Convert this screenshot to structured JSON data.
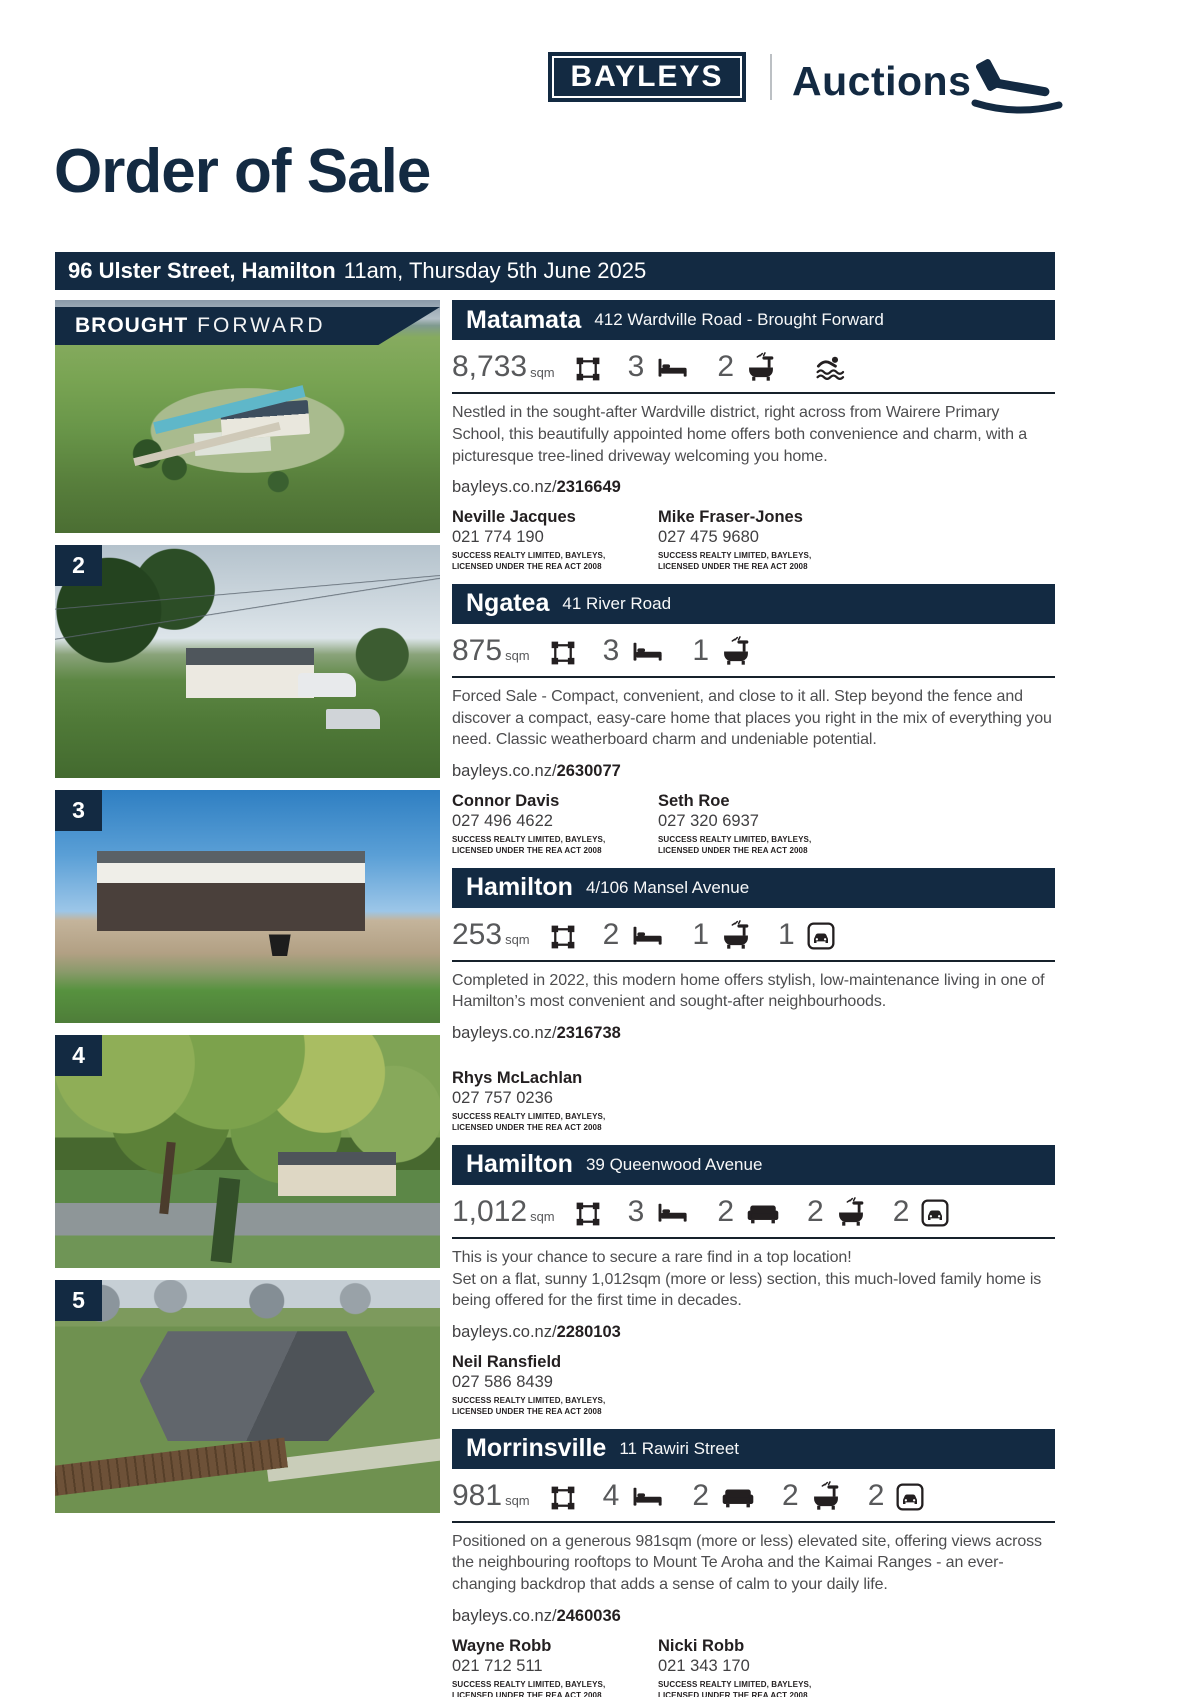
{
  "colors": {
    "navy": "#132a42",
    "body_text": "#4d4d4f",
    "stat_gray": "#58595b",
    "icon_ink": "#231f20"
  },
  "brand": {
    "logo_text": "BAYLEYS",
    "section_label": "Auctions"
  },
  "page": {
    "title": "Order of Sale",
    "auction_venue": "96 Ulster Street, Hamilton",
    "auction_time": "11am, Thursday 5th June 2025"
  },
  "license": {
    "line1": "SUCCESS REALTY LIMITED, BAYLEYS,",
    "line2": "LICENSED UNDER THE REA ACT 2008"
  },
  "properties": [
    {
      "banner": {
        "bold": "BROUGHT",
        "light": "FORWARD"
      },
      "town": "Matamata",
      "address": "412 Wardville Road - Brought Forward",
      "stats": [
        {
          "value": "8,733",
          "unit": "sqm",
          "icon": "land-icon"
        },
        {
          "value": "3",
          "icon": "bed-icon"
        },
        {
          "value": "2",
          "icon": "bath-icon"
        },
        {
          "icon": "pool-icon"
        }
      ],
      "description": "Nestled in the sought-after Wardville district, right across from Wairere Primary School, this beautifully appointed home offers both convenience and charm, with a picturesque tree-lined driveway welcoming you home.",
      "link": {
        "prefix": "bayleys.co.nz/",
        "id": "2316649"
      },
      "agents": [
        {
          "name": "Neville Jacques",
          "phone": "021 774 190"
        },
        {
          "name": "Mike Fraser-Jones",
          "phone": "027 475 9680"
        }
      ]
    },
    {
      "badge": "2",
      "town": "Ngatea",
      "address": "41 River Road",
      "stats": [
        {
          "value": "875",
          "unit": "sqm",
          "icon": "land-icon"
        },
        {
          "value": "3",
          "icon": "bed-icon"
        },
        {
          "value": "1",
          "icon": "bath-icon"
        }
      ],
      "description": "Forced Sale - Compact, convenient, and close to it all. Step beyond the fence and discover a compact, easy-care home that places you right in the mix of everything you need. Classic weatherboard charm and undeniable potential.",
      "link": {
        "prefix": "bayleys.co.nz/",
        "id": "2630077"
      },
      "agents": [
        {
          "name": "Connor Davis",
          "phone": "027 496 4622"
        },
        {
          "name": "Seth Roe",
          "phone": "027 320 6937"
        }
      ]
    },
    {
      "badge": "3",
      "town": "Hamilton",
      "address": "4/106 Mansel Avenue",
      "stats": [
        {
          "value": "253",
          "unit": "sqm",
          "icon": "land-icon"
        },
        {
          "value": "2",
          "icon": "bed-icon"
        },
        {
          "value": "1",
          "icon": "bath-icon"
        },
        {
          "value": "1",
          "icon": "car-icon"
        }
      ],
      "description": "Completed in 2022, this modern home offers stylish, low-maintenance living in one of Hamilton’s most convenient and sought-after neighbourhoods.",
      "link": {
        "prefix": "bayleys.co.nz/",
        "id": "2316738"
      },
      "agents": [
        {
          "name": "Rhys McLachlan",
          "phone": "027 757 0236"
        }
      ]
    },
    {
      "badge": "4",
      "town": "Hamilton",
      "address": "39 Queenwood Avenue",
      "stats": [
        {
          "value": "1,012",
          "unit": "sqm",
          "icon": "land-icon"
        },
        {
          "value": "3",
          "icon": "bed-icon"
        },
        {
          "value": "2",
          "icon": "sofa-icon"
        },
        {
          "value": "2",
          "icon": "bath-icon"
        },
        {
          "value": "2",
          "icon": "car-icon"
        }
      ],
      "description": "This is your chance to secure a rare find in a top location!\nSet on a flat, sunny 1,012sqm (more or less) section, this much-loved family home is being offered for the first time in decades.",
      "link": {
        "prefix": "bayleys.co.nz/",
        "id": "2280103"
      },
      "agents": [
        {
          "name": "Neil Ransfield",
          "phone": "027 586 8439"
        }
      ]
    },
    {
      "badge": "5",
      "town": "Morrinsville",
      "address": "11 Rawiri Street",
      "stats": [
        {
          "value": "981",
          "unit": "sqm",
          "icon": "land-icon"
        },
        {
          "value": "4",
          "icon": "bed-icon"
        },
        {
          "value": "2",
          "icon": "sofa-icon"
        },
        {
          "value": "2",
          "icon": "bath-icon"
        },
        {
          "value": "2",
          "icon": "car-icon"
        }
      ],
      "description": "Positioned on a generous 981sqm (more or less) elevated site, offering views across the neighbouring rooftops to Mount Te Aroha and the Kaimai Ranges - an ever-changing backdrop that adds a sense of calm to your daily life.",
      "link": {
        "prefix": "bayleys.co.nz/",
        "id": "2460036"
      },
      "agents": [
        {
          "name": "Wayne Robb",
          "phone": "021 712 511"
        },
        {
          "name": "Nicki Robb",
          "phone": "021 343 170"
        }
      ]
    }
  ]
}
